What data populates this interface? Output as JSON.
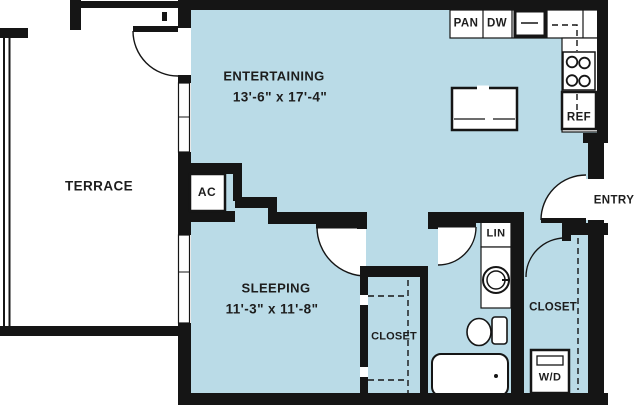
{
  "colors": {
    "floor": "#badbe7",
    "wall": "#151515",
    "text": "#1d1d1d",
    "background": "#ffffff",
    "fixture": "#ffffff"
  },
  "rooms": {
    "terrace": {
      "label": "TERRACE"
    },
    "entertaining": {
      "label": "ENTERTAINING",
      "dimensions": "13'-6\" x 17'-4\""
    },
    "sleeping": {
      "label": "SLEEPING",
      "dimensions": "11'-3\" x 11'-8\""
    },
    "bedroom_closet": {
      "label": "CLOSET"
    },
    "entry_closet": {
      "label": "CLOSET"
    },
    "entry": {
      "label": "ENTRY"
    }
  },
  "fixtures": {
    "pantry": "PAN",
    "dishwasher": "DW",
    "refrigerator": "REF",
    "linen": "LIN",
    "washer_dryer": "W/D",
    "air_conditioner": "AC"
  }
}
